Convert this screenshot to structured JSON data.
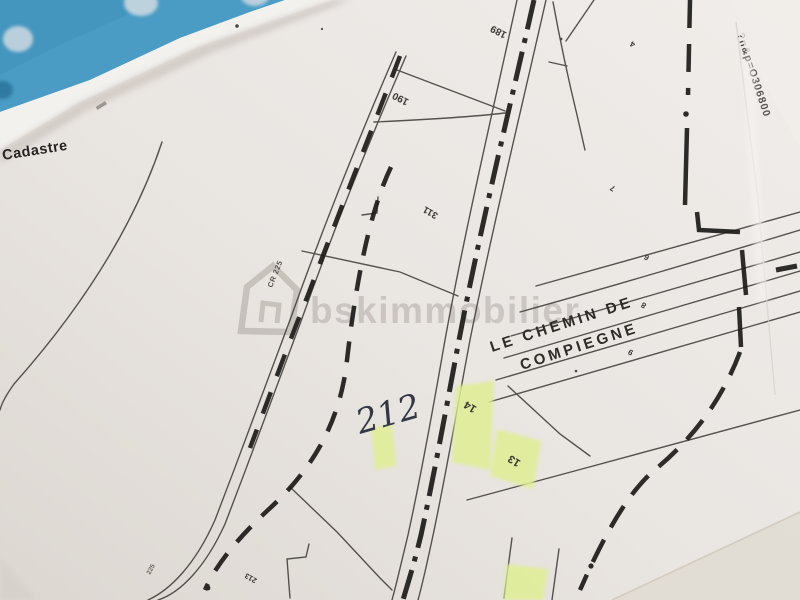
{
  "photo": {
    "kind": "photograph of a paper cadastral map in a blue binder",
    "highlight_color": "#e0ee93",
    "binder_color": "#4a9cc4",
    "paper_color": "#e9e5e1",
    "ink_color": "#3f3d3a"
  },
  "corner": {
    "label": "Cadastre"
  },
  "watermark": {
    "text": "bskimmobilier"
  },
  "edge_print": {
    "url_fragment": "?n&p=O306800"
  },
  "road": {
    "name_line1": "LE  CHEMIN  DE",
    "name_line2": "COMPIEGNE",
    "code_upper": "CR 225",
    "code_lower": "225"
  },
  "handwritten": {
    "note": "212"
  },
  "parcels": [
    {
      "id": "189"
    },
    {
      "id": "190"
    },
    {
      "id": "311"
    },
    {
      "id": "213"
    },
    {
      "id": "4"
    },
    {
      "id": "7"
    },
    {
      "id": "6"
    },
    {
      "id": "8"
    },
    {
      "id": "9"
    },
    {
      "id": "14"
    },
    {
      "id": "13"
    }
  ]
}
